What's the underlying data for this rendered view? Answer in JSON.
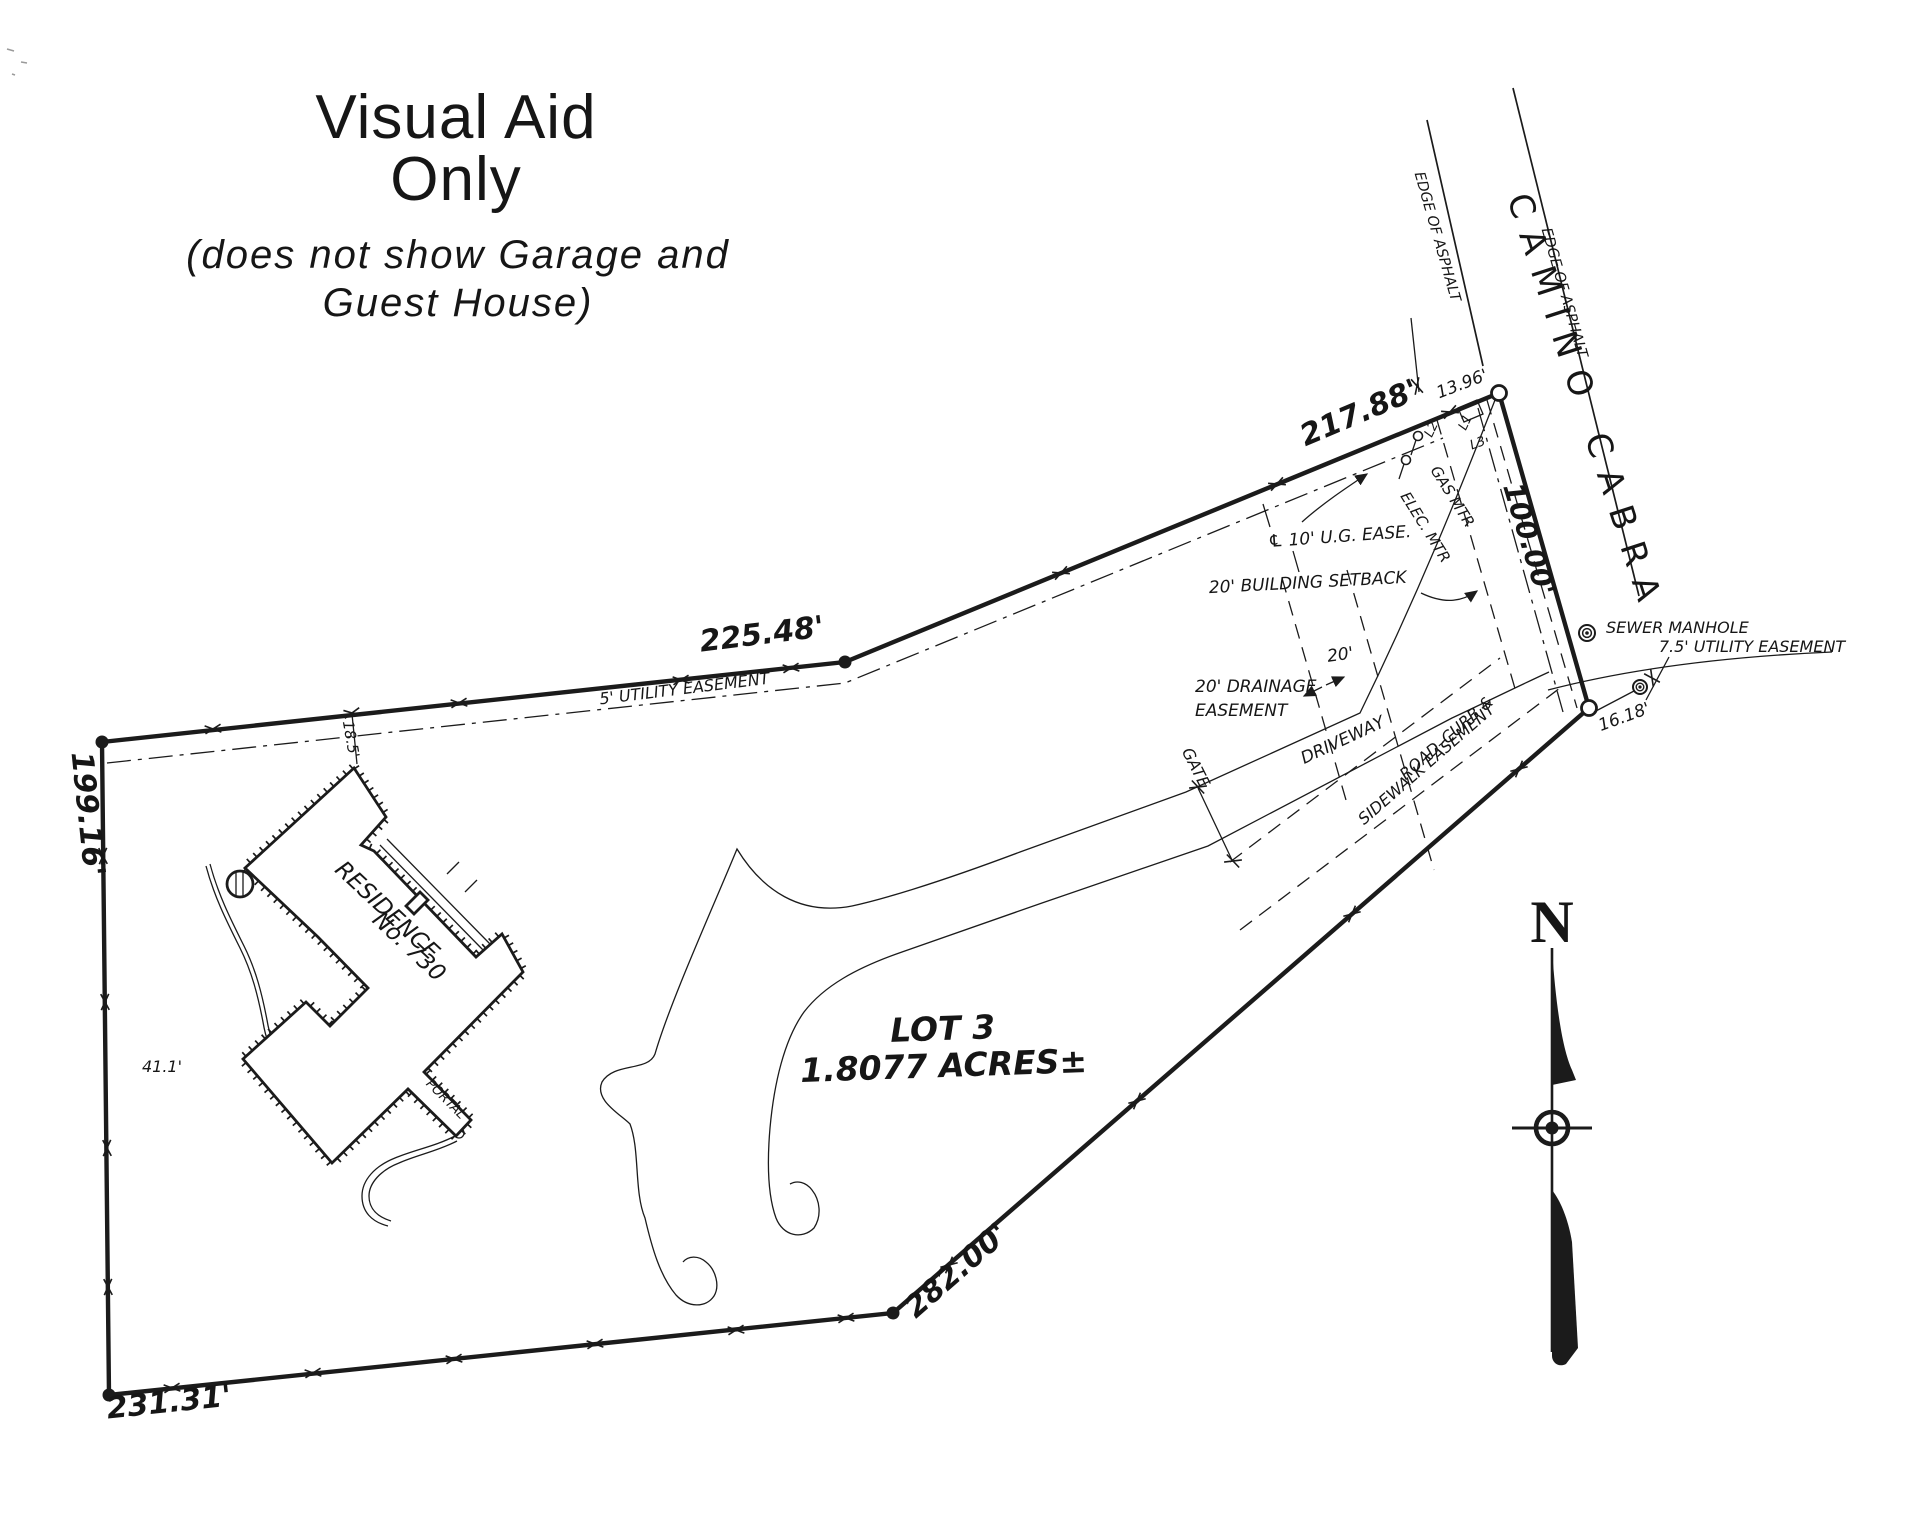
{
  "title": {
    "line1": "Visual Aid",
    "line2": "Only",
    "subtitle_line1": "(does not show Garage and",
    "subtitle_line2": "Guest House)"
  },
  "road": {
    "name": "CAMINO CABRA",
    "edge_left": "EDGE OF ASPHALT",
    "edge_right": "EDGE OF ASPHALT"
  },
  "lot": {
    "label": "LOT 3",
    "area": "1.8077 ACRES±"
  },
  "residence": {
    "line1": "RESIDENCE",
    "line2": "No. 730",
    "portal": "PORTAL"
  },
  "dimensions": {
    "north": "225.48'",
    "northeast": "217.88'",
    "frontage": "100.00'",
    "southeast": "282.00'",
    "south": "231.31'",
    "west": "199.16'",
    "tie_ne": "13.96'",
    "tie_se": "16.18'",
    "house_offset": "18.5'",
    "house_west": "41.1'"
  },
  "easements": {
    "utility_5": "5' UTILITY EASEMENT",
    "ug_10": "℄ 10' U.G. EASE.",
    "building_setback": "20' BUILDING SETBACK",
    "drainage_line1": "20' DRAINAGE",
    "drainage_line2": "EASEMENT",
    "drainage_width": "20'",
    "utility_75": "7.5' UTILITY EASEMENT",
    "road_curb_line1": "ROAD–CURB &",
    "road_curb_line2": "SIDEWALK EASEMENT"
  },
  "features": {
    "sewer_manhole": "SEWER MANHOLE",
    "gas_meter": "GAS MTR",
    "electric_meter": "ELEC. MTR",
    "gate": "GATE",
    "driveway": "DRIVEWAY",
    "north_arrow": "N"
  },
  "line_refs": {
    "l1": "L1",
    "l2": "L2",
    "l3": "L3"
  },
  "icons": {
    "manhole": "double-circle",
    "meter": "lollipop-circle",
    "fence_tick": "x-mark",
    "north_needle": "compass-needle"
  },
  "colors": {
    "ink": "#1b1b1b",
    "paper": "#ffffff"
  }
}
